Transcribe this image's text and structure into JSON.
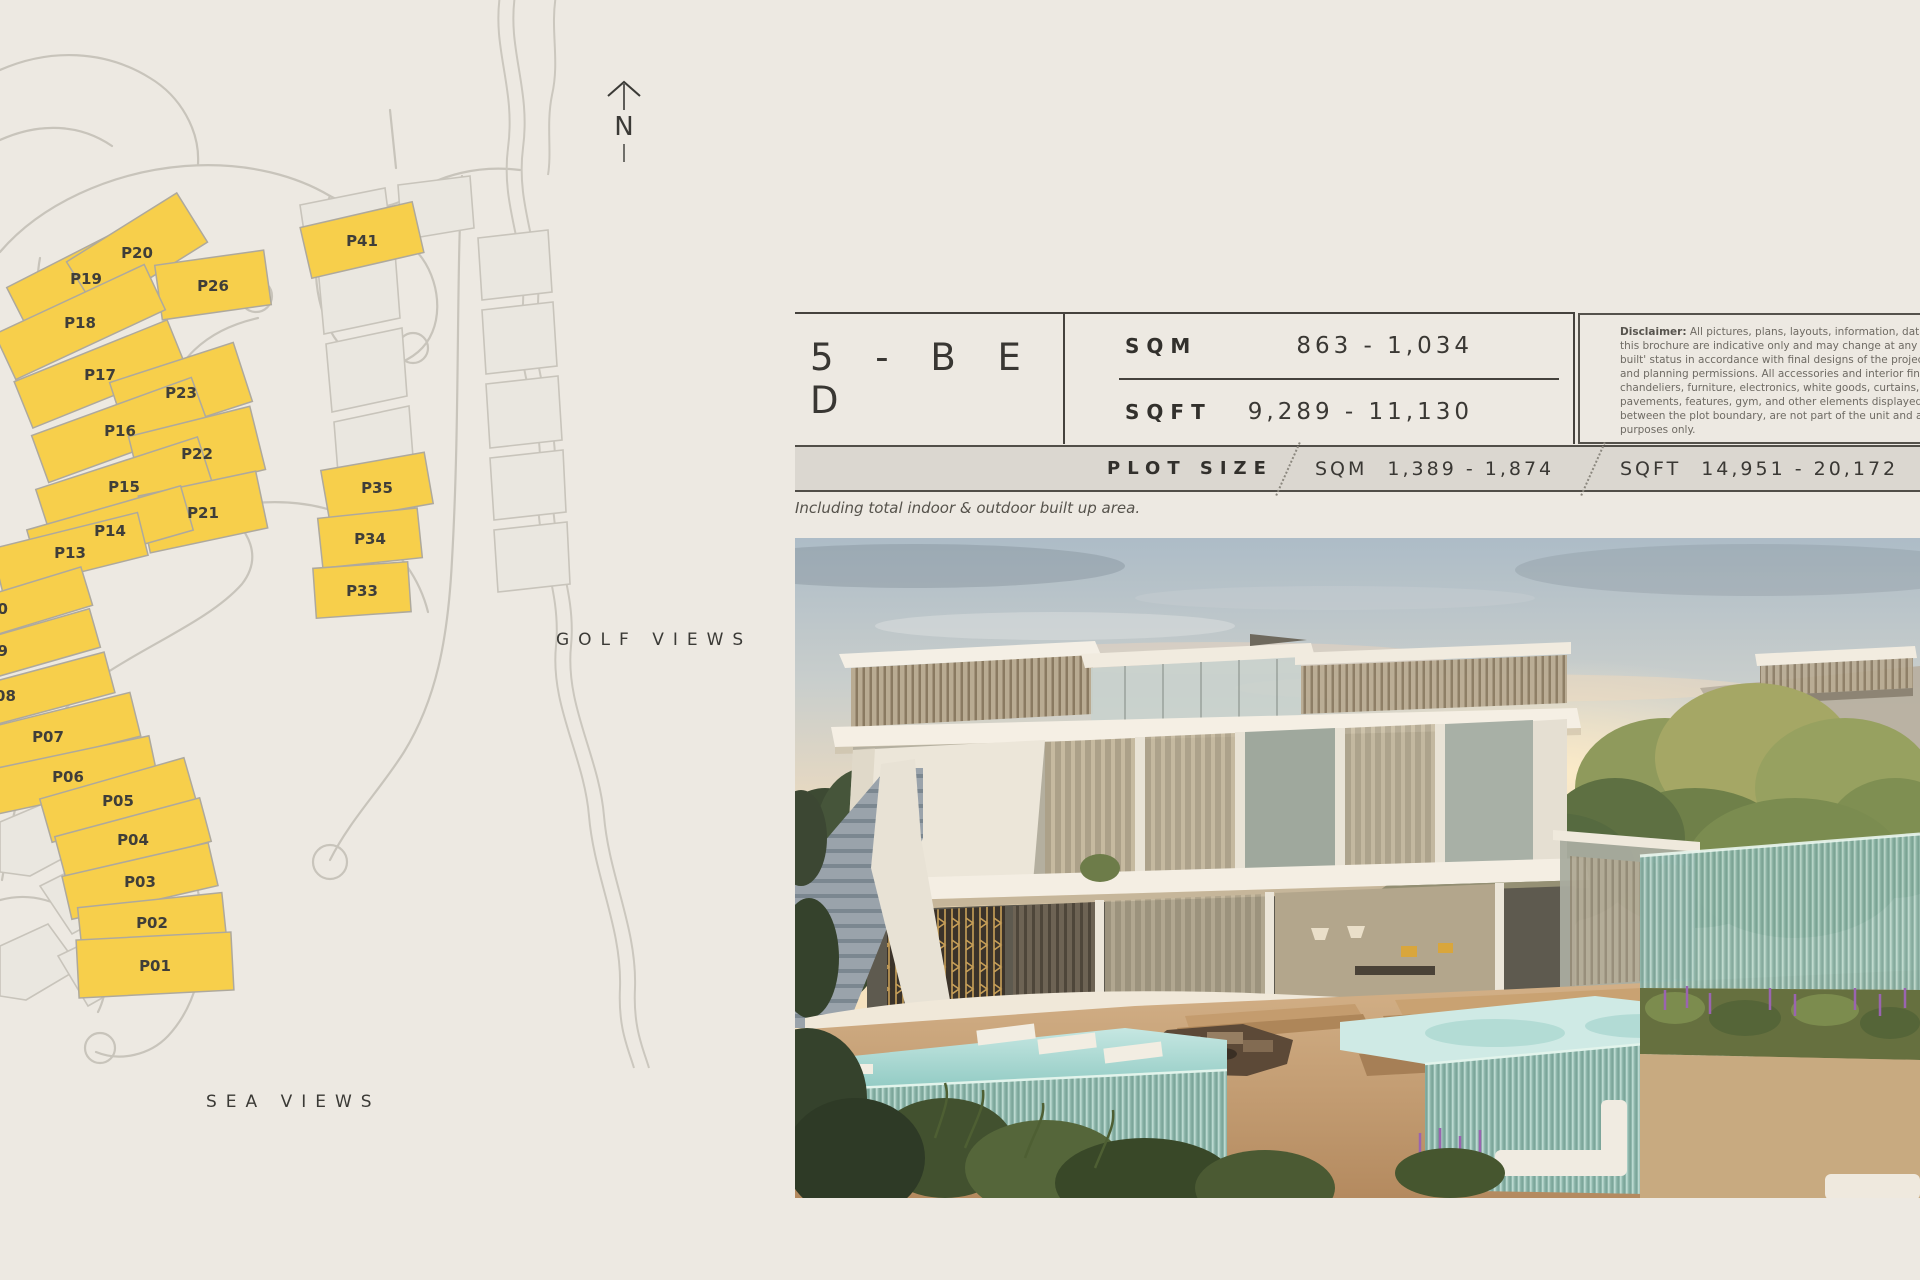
{
  "map": {
    "north_label": "N",
    "golf_views_label": "GOLF VIEWS",
    "sea_views_label": "SEA VIEWS",
    "plot_highlight_color": "#F7CF4B",
    "plots": [
      {
        "label": "P19"
      },
      {
        "label": "P20"
      },
      {
        "label": "P26"
      },
      {
        "label": "P41"
      },
      {
        "label": "P18"
      },
      {
        "label": "P17"
      },
      {
        "label": "P23"
      },
      {
        "label": "P16"
      },
      {
        "label": "P22"
      },
      {
        "label": "P15"
      },
      {
        "label": "P21"
      },
      {
        "label": "P14"
      },
      {
        "label": "P13"
      },
      {
        "label": "P35"
      },
      {
        "label": "P34"
      },
      {
        "label": "P33"
      },
      {
        "label": "P10"
      },
      {
        "label": "P09"
      },
      {
        "label": "P08"
      },
      {
        "label": "P07"
      },
      {
        "label": "P06"
      },
      {
        "label": "P05"
      },
      {
        "label": "P04"
      },
      {
        "label": "P03"
      },
      {
        "label": "P02"
      },
      {
        "label": "P01"
      }
    ]
  },
  "spec": {
    "bedrooms_label": "5 - B E D",
    "area_rows": [
      {
        "unit": "SQM",
        "range": "863 - 1,034"
      },
      {
        "unit": "SQFT",
        "range": "9,289 - 11,130"
      }
    ],
    "plot_size": {
      "label": "PLOT SIZE",
      "items": [
        {
          "unit": "SQM",
          "range": "1,389 - 1,874"
        },
        {
          "unit": "SQFT",
          "range": "14,951 - 20,172"
        }
      ]
    },
    "footnote": "Including total indoor & outdoor built up area."
  },
  "disclaimer": {
    "label": "Disclaimer:",
    "lines": [
      "All pictures, plans, layouts, information, data and",
      "this brochure are indicative only and may change at any time",
      "built' status in accordance with final designs of the project, r",
      "and planning permissions. All accessories and interior finishes",
      "chandeliers, furniture, electronics, white goods, curtains, hard",
      "pavements, features, gym, and other elements displayed i",
      "between the plot boundary, are not part of the unit and are sl",
      "purposes only."
    ]
  },
  "colors": {
    "page_background": "#EDE9E2",
    "bar_background": "#DBD7D0",
    "rule_dark": "#45423D",
    "pool_teal": "#9FD0C9"
  }
}
